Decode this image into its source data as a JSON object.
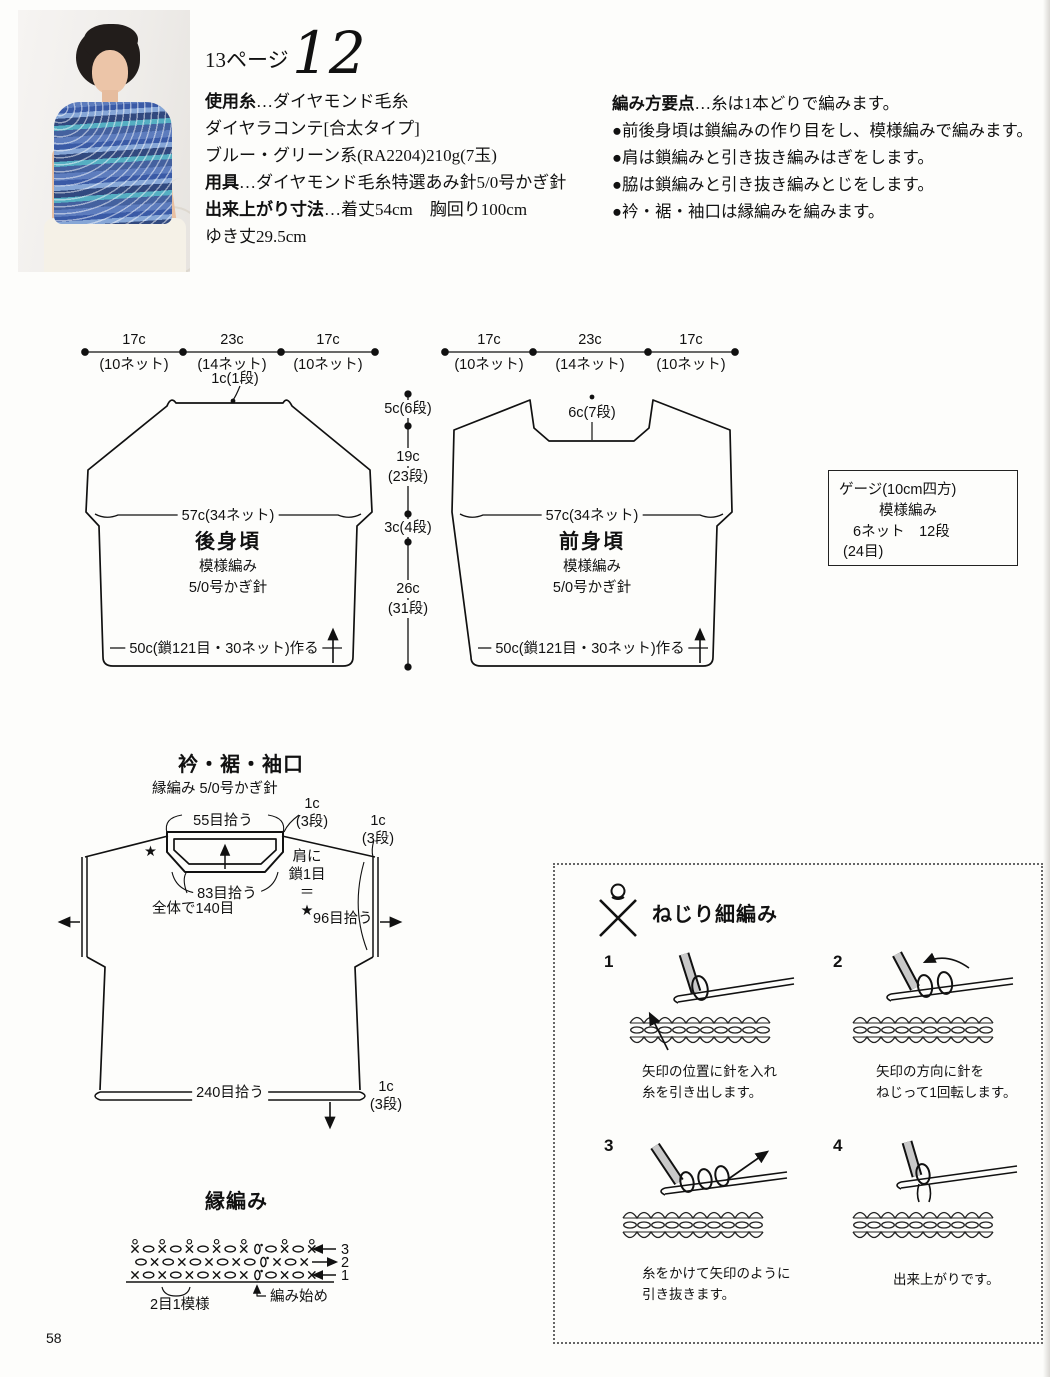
{
  "page": {
    "number": "58"
  },
  "header": {
    "page_ref": "13ページ",
    "design_number": "12"
  },
  "materials": {
    "lines": [
      {
        "b": "使用糸",
        "t": "…ダイヤモンド毛糸"
      },
      {
        "b": "",
        "t": "ダイヤラコンテ[合太タイプ]"
      },
      {
        "b": "",
        "t": "ブルー・グリーン系(RA2204)210g(7玉)"
      },
      {
        "b": "用具",
        "t": "…ダイヤモンド毛糸特選あみ針5/0号かぎ針"
      },
      {
        "b": "出来上がり寸法",
        "t": "…着丈54cm　胸回り100cm"
      },
      {
        "b": "",
        "t": "ゆき丈29.5cm"
      }
    ]
  },
  "howto": {
    "lines": [
      {
        "b": "編み方要点",
        "t": "…糸は1本どりで編みます。"
      },
      {
        "b": "",
        "t": "●前後身頃は鎖編みの作り目をし、模様編みで編みます。"
      },
      {
        "b": "",
        "t": "●肩は鎖編みと引き抜き編みはぎをします。"
      },
      {
        "b": "",
        "t": "●脇は鎖編みと引き抜き編みとじをします。"
      },
      {
        "b": "",
        "t": "●衿・裾・袖口は縁編みを編みます。"
      }
    ]
  },
  "back_piece": {
    "name": "後身頃",
    "stitch": "模様編み",
    "hook": "5/0号かぎ針",
    "top_measures": [
      {
        "v": "17c",
        "s": "(10ネット)"
      },
      {
        "v": "23c",
        "s": "(14ネット)"
      },
      {
        "v": "17c",
        "s": "(10ネット)"
      }
    ],
    "neck": "1c(1段)",
    "width": "57c(34ネット)",
    "bottom": "50c(鎖121目・30ネット)作る"
  },
  "front_piece": {
    "name": "前身頃",
    "stitch": "模様編み",
    "hook": "5/0号かぎ針",
    "top_measures": [
      {
        "v": "17c",
        "s": "(10ネット)"
      },
      {
        "v": "23c",
        "s": "(14ネット)"
      },
      {
        "v": "17c",
        "s": "(10ネット)"
      }
    ],
    "neck": "6c(7段)",
    "width": "57c(34ネット)",
    "bottom": "50c(鎖121目・30ネット)作る"
  },
  "side_measures": {
    "m1": "5c(6段)",
    "m2": "19c",
    "m2b": "(23段)",
    "m3": "3c(4段)",
    "m4": "26c",
    "m4b": "(31段)"
  },
  "gauge": {
    "l1": "ゲージ(10cm四方)",
    "l2": "模様編み",
    "l3": "6ネット　12段",
    "l4": "(24目)"
  },
  "edging": {
    "title": "衿・裾・袖口",
    "subtitle": "縁編み 5/0号かぎ針",
    "neck_pickup": "55目拾う",
    "neck_rows": "1c\n(3段)",
    "star": "★",
    "inner_pickup": "83目拾う",
    "total": "全体で140目",
    "shoulder_note": "肩に\n鎖1目\n＝\n★",
    "arm_pickup": "96目拾う",
    "arm_rows": "1c\n(3段)",
    "hem_pickup": "240目拾う",
    "hem_rows": "1c\n(3段)"
  },
  "edge_chart": {
    "title": "縁編み",
    "rows": [
      {
        "num": "3",
        "offset": 0,
        "cells": [
          "X",
          "o",
          "X",
          "o",
          "X",
          "o",
          "X",
          "o",
          "X",
          "0",
          "o",
          "X",
          "o",
          "X"
        ]
      },
      {
        "num": "2",
        "offset": 6,
        "cells": [
          "o",
          "x",
          "o",
          "x",
          "o",
          "x",
          "o",
          "x",
          "o",
          "0",
          "x",
          "o",
          "x"
        ]
      },
      {
        "num": "1",
        "offset": 0,
        "cells": [
          "x",
          "o",
          "x",
          "o",
          "x",
          "o",
          "x",
          "o",
          "x",
          "0",
          "o",
          "x",
          "o",
          "x"
        ]
      }
    ],
    "pattern_note": "2目1模様",
    "start_note": "編み始め"
  },
  "technique": {
    "title": "ねじり細編み",
    "steps": [
      {
        "num": "1",
        "caption": "矢印の位置に針を入れ\n糸を引き出します。"
      },
      {
        "num": "2",
        "caption": "矢印の方向に針を\nねじって1回転します。"
      },
      {
        "num": "3",
        "caption": "糸をかけて矢印のように\n引き抜きます。"
      },
      {
        "num": "4",
        "caption": "出来上がりです。"
      }
    ]
  }
}
